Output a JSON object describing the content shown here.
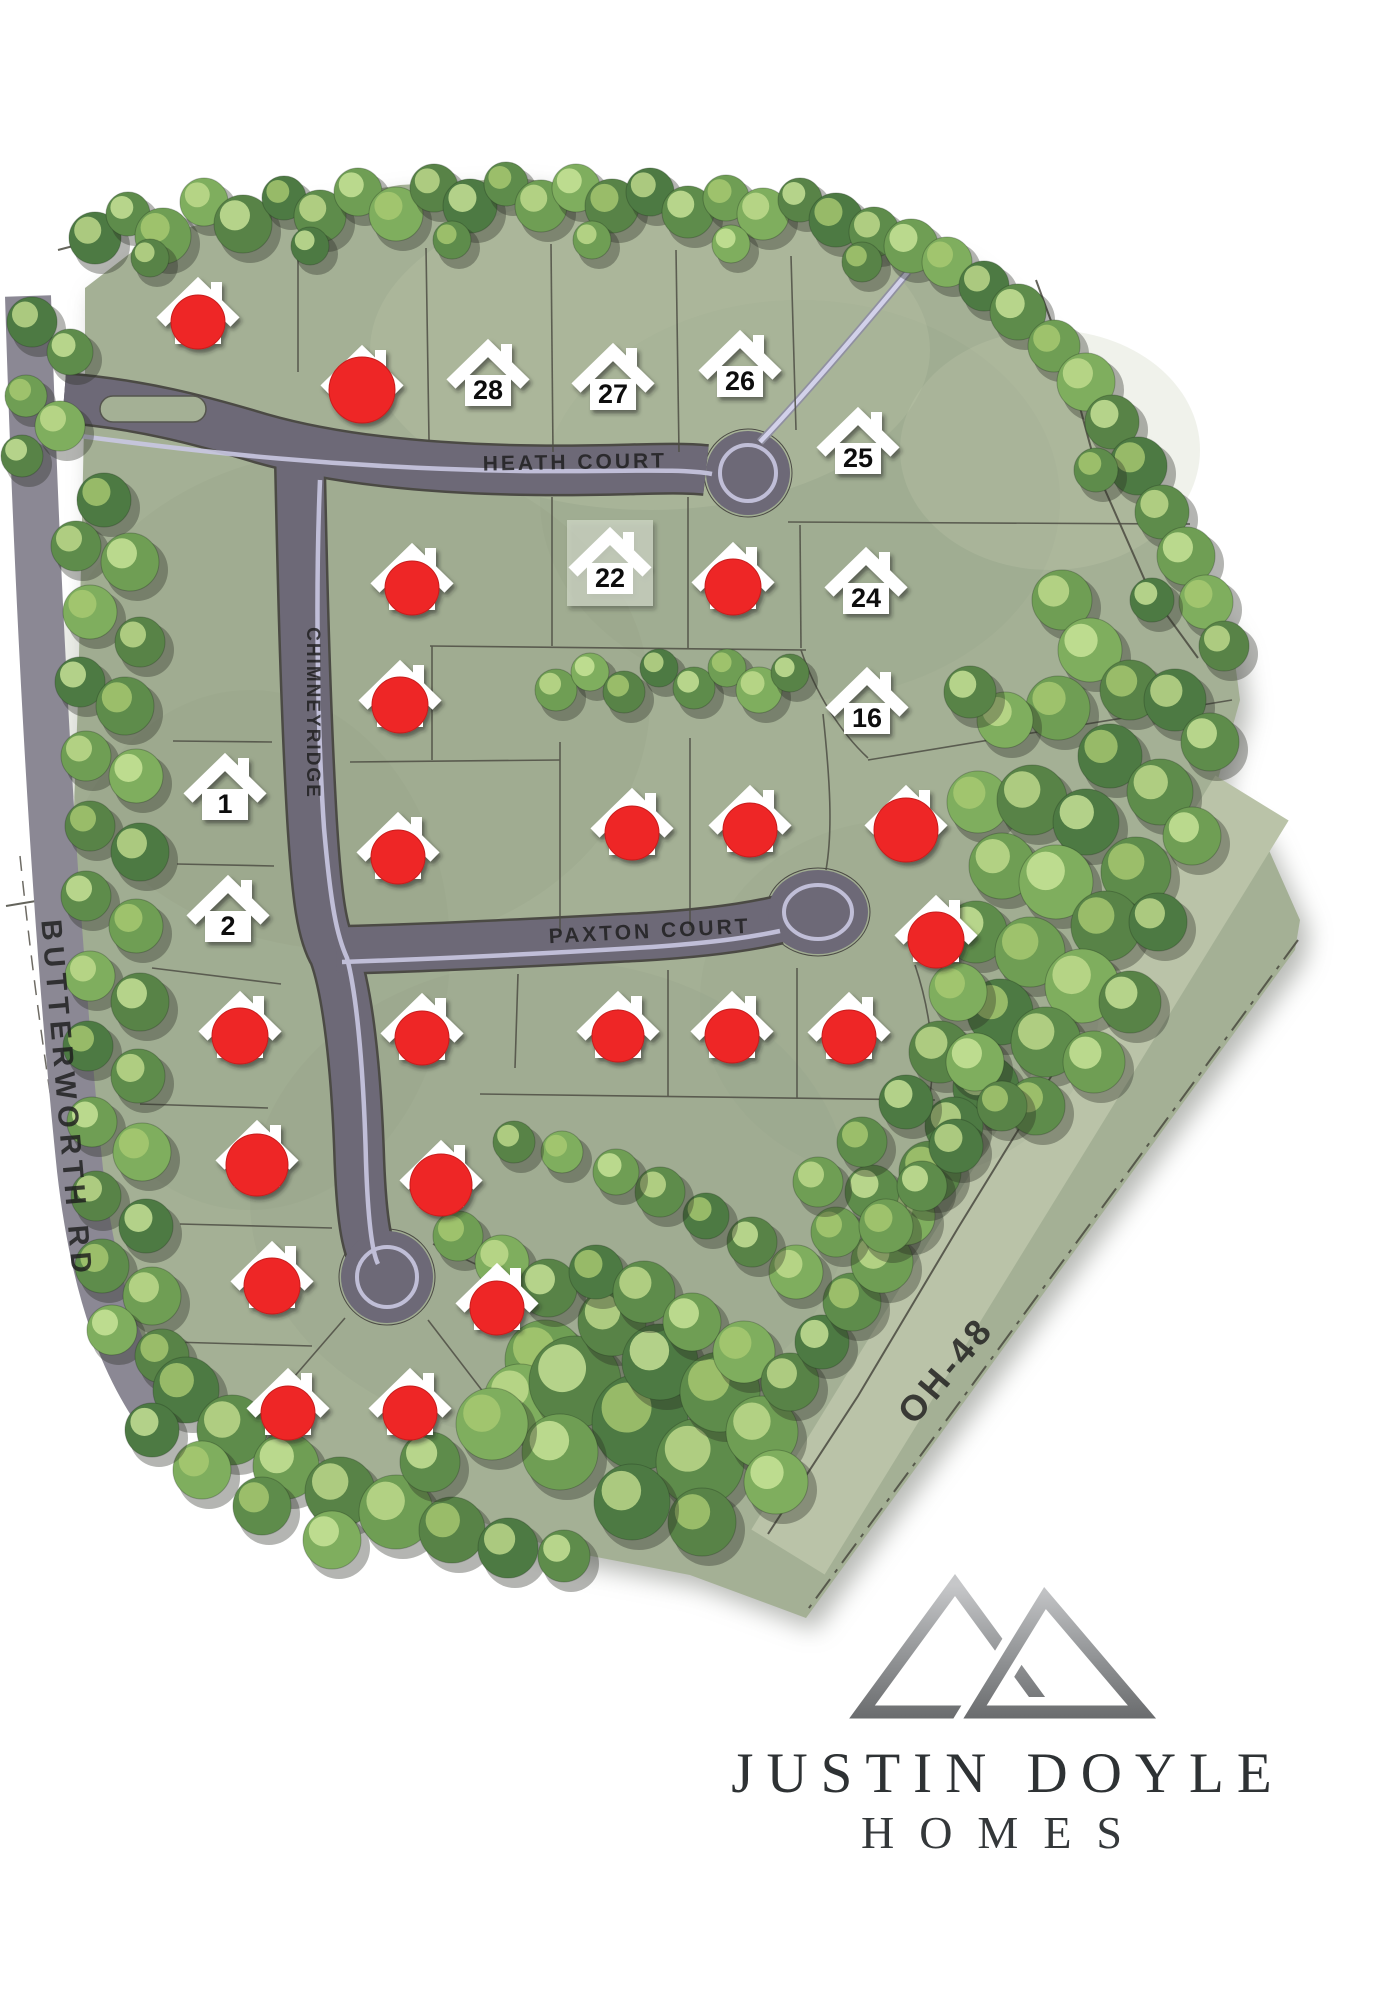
{
  "branding": {
    "name_line1": "JUSTIN DOYLE",
    "name_line2": "HOMES"
  },
  "colors": {
    "site_green": "#a4b095",
    "corridor_green": "#bac3a8",
    "road": "#6d6977",
    "road_edge": "#4b4a44",
    "road_stripe": "#c9c8e2",
    "sold_red": "#ee2525",
    "house_white": "#ffffff",
    "label_ink": "#1d1d1d",
    "logo_text": "#2e3234"
  },
  "streets": {
    "labels": [
      {
        "id": "heath-court",
        "text": "HEATH COURT",
        "x": 575,
        "y": 469,
        "rot": -1,
        "fs": 21,
        "ls": 3
      },
      {
        "id": "paxton-court",
        "text": "PAXTON COURT",
        "x": 650,
        "y": 938,
        "rot": -3,
        "fs": 21,
        "ls": 3
      },
      {
        "id": "chimneyridge",
        "text": "CHIMNEYRIDGE",
        "x": 307,
        "y": 713,
        "rot": 90,
        "fs": 19,
        "ls": 2
      },
      {
        "id": "butterworth-rd",
        "text": "BUTTERWORTH RD",
        "x": 57,
        "y": 1100,
        "rot": 85,
        "fs": 29,
        "ls": 6
      },
      {
        "id": "oh-48",
        "text": "OH-48",
        "x": 955,
        "y": 1378,
        "rot": -50,
        "fs": 36,
        "ls": 4
      }
    ]
  },
  "lots": {
    "available": [
      {
        "num": "1",
        "x": 225,
        "y": 788
      },
      {
        "num": "2",
        "x": 228,
        "y": 910
      },
      {
        "num": "16",
        "x": 867,
        "y": 702
      },
      {
        "num": "22",
        "x": 610,
        "y": 562,
        "highlight": true
      },
      {
        "num": "24",
        "x": 866,
        "y": 582
      },
      {
        "num": "25",
        "x": 858,
        "y": 442
      },
      {
        "num": "26",
        "x": 740,
        "y": 365
      },
      {
        "num": "27",
        "x": 613,
        "y": 378
      },
      {
        "num": "28",
        "x": 488,
        "y": 374
      }
    ],
    "sold": [
      {
        "x": 198,
        "y": 312,
        "r": 27
      },
      {
        "x": 362,
        "y": 380,
        "r": 33
      },
      {
        "x": 412,
        "y": 578,
        "r": 27
      },
      {
        "x": 733,
        "y": 577,
        "r": 28
      },
      {
        "x": 400,
        "y": 695,
        "r": 28
      },
      {
        "x": 632,
        "y": 823,
        "r": 27
      },
      {
        "x": 750,
        "y": 820,
        "r": 27
      },
      {
        "x": 906,
        "y": 820,
        "r": 32
      },
      {
        "x": 398,
        "y": 847,
        "r": 27
      },
      {
        "x": 936,
        "y": 930,
        "r": 28
      },
      {
        "x": 240,
        "y": 1026,
        "r": 28
      },
      {
        "x": 422,
        "y": 1028,
        "r": 27
      },
      {
        "x": 618,
        "y": 1026,
        "r": 26
      },
      {
        "x": 732,
        "y": 1026,
        "r": 27
      },
      {
        "x": 849,
        "y": 1027,
        "r": 27
      },
      {
        "x": 257,
        "y": 1155,
        "r": 31
      },
      {
        "x": 441,
        "y": 1175,
        "r": 31
      },
      {
        "x": 272,
        "y": 1276,
        "r": 28
      },
      {
        "x": 497,
        "y": 1298,
        "r": 27
      },
      {
        "x": 288,
        "y": 1403,
        "r": 27
      },
      {
        "x": 410,
        "y": 1403,
        "r": 27
      }
    ]
  },
  "trees": {
    "items": [
      [
        95,
        238,
        26
      ],
      [
        128,
        214,
        22
      ],
      [
        163,
        236,
        28
      ],
      [
        204,
        202,
        24
      ],
      [
        243,
        224,
        29
      ],
      [
        284,
        198,
        22
      ],
      [
        320,
        216,
        26
      ],
      [
        358,
        192,
        24
      ],
      [
        396,
        214,
        27
      ],
      [
        434,
        188,
        24
      ],
      [
        470,
        206,
        27
      ],
      [
        506,
        184,
        22
      ],
      [
        541,
        206,
        26
      ],
      [
        576,
        188,
        24
      ],
      [
        612,
        206,
        27
      ],
      [
        650,
        192,
        24
      ],
      [
        688,
        212,
        26
      ],
      [
        726,
        198,
        23
      ],
      [
        763,
        214,
        26
      ],
      [
        800,
        200,
        22
      ],
      [
        836,
        220,
        27
      ],
      [
        874,
        232,
        25
      ],
      [
        911,
        246,
        27
      ],
      [
        947,
        262,
        25
      ],
      [
        150,
        258,
        19
      ],
      [
        310,
        246,
        19
      ],
      [
        452,
        240,
        19
      ],
      [
        592,
        240,
        19
      ],
      [
        731,
        244,
        19
      ],
      [
        862,
        262,
        20
      ],
      [
        984,
        286,
        25
      ],
      [
        1018,
        312,
        28
      ],
      [
        1054,
        346,
        26
      ],
      [
        1086,
        382,
        29
      ],
      [
        1112,
        422,
        27
      ],
      [
        1138,
        466,
        29
      ],
      [
        1162,
        512,
        27
      ],
      [
        1186,
        556,
        29
      ],
      [
        1206,
        602,
        27
      ],
      [
        1224,
        646,
        25
      ],
      [
        1152,
        600,
        22
      ],
      [
        1096,
        470,
        22
      ],
      [
        1062,
        600,
        30
      ],
      [
        1090,
        650,
        32
      ],
      [
        1130,
        690,
        30
      ],
      [
        1175,
        700,
        31
      ],
      [
        1210,
        742,
        29
      ],
      [
        1058,
        708,
        32
      ],
      [
        1005,
        720,
        28
      ],
      [
        970,
        692,
        26
      ],
      [
        1110,
        756,
        32
      ],
      [
        1160,
        792,
        33
      ],
      [
        1192,
        836,
        29
      ],
      [
        978,
        802,
        31
      ],
      [
        1032,
        800,
        35
      ],
      [
        1086,
        822,
        33
      ],
      [
        1136,
        872,
        35
      ],
      [
        1002,
        866,
        33
      ],
      [
        1056,
        882,
        37
      ],
      [
        1106,
        926,
        35
      ],
      [
        1158,
        922,
        29
      ],
      [
        976,
        932,
        31
      ],
      [
        1030,
        952,
        35
      ],
      [
        1082,
        986,
        37
      ],
      [
        1130,
        1002,
        31
      ],
      [
        1000,
        1012,
        33
      ],
      [
        1046,
        1042,
        35
      ],
      [
        1094,
        1062,
        31
      ],
      [
        958,
        992,
        29
      ],
      [
        940,
        1052,
        31
      ],
      [
        986,
        1088,
        33
      ],
      [
        1036,
        1106,
        29
      ],
      [
        556,
        690,
        21
      ],
      [
        590,
        672,
        19
      ],
      [
        624,
        692,
        21
      ],
      [
        659,
        668,
        19
      ],
      [
        694,
        688,
        21
      ],
      [
        727,
        668,
        19
      ],
      [
        759,
        690,
        23
      ],
      [
        790,
        673,
        19
      ],
      [
        104,
        500,
        27
      ],
      [
        76,
        546,
        25
      ],
      [
        130,
        562,
        29
      ],
      [
        90,
        612,
        27
      ],
      [
        140,
        642,
        25
      ],
      [
        80,
        682,
        25
      ],
      [
        125,
        706,
        29
      ],
      [
        86,
        756,
        25
      ],
      [
        136,
        776,
        27
      ],
      [
        90,
        826,
        25
      ],
      [
        140,
        852,
        29
      ],
      [
        86,
        896,
        25
      ],
      [
        136,
        926,
        27
      ],
      [
        90,
        976,
        25
      ],
      [
        140,
        1002,
        29
      ],
      [
        88,
        1046,
        25
      ],
      [
        138,
        1076,
        27
      ],
      [
        92,
        1122,
        25
      ],
      [
        142,
        1152,
        29
      ],
      [
        96,
        1196,
        25
      ],
      [
        146,
        1226,
        27
      ],
      [
        102,
        1266,
        27
      ],
      [
        152,
        1296,
        29
      ],
      [
        112,
        1330,
        25
      ],
      [
        162,
        1356,
        27
      ],
      [
        32,
        322,
        25
      ],
      [
        70,
        352,
        23
      ],
      [
        26,
        396,
        21
      ],
      [
        60,
        426,
        25
      ],
      [
        22,
        456,
        21
      ],
      [
        186,
        1390,
        33
      ],
      [
        232,
        1430,
        35
      ],
      [
        286,
        1466,
        33
      ],
      [
        202,
        1470,
        29
      ],
      [
        340,
        1492,
        35
      ],
      [
        152,
        1430,
        27
      ],
      [
        262,
        1506,
        29
      ],
      [
        396,
        1512,
        37
      ],
      [
        332,
        1540,
        29
      ],
      [
        452,
        1530,
        33
      ],
      [
        508,
        1548,
        30
      ],
      [
        564,
        1556,
        26
      ],
      [
        545,
        1360,
        40
      ],
      [
        520,
        1400,
        36
      ],
      [
        575,
        1382,
        46
      ],
      [
        640,
        1422,
        48
      ],
      [
        700,
        1462,
        44
      ],
      [
        560,
        1452,
        38
      ],
      [
        492,
        1424,
        36
      ],
      [
        612,
        1322,
        34
      ],
      [
        660,
        1362,
        38
      ],
      [
        720,
        1392,
        40
      ],
      [
        762,
        1432,
        36
      ],
      [
        776,
        1482,
        32
      ],
      [
        702,
        1522,
        34
      ],
      [
        632,
        1502,
        38
      ],
      [
        430,
        1462,
        30
      ],
      [
        458,
        1236,
        25
      ],
      [
        502,
        1262,
        27
      ],
      [
        548,
        1288,
        29
      ],
      [
        596,
        1272,
        27
      ],
      [
        644,
        1292,
        31
      ],
      [
        692,
        1322,
        29
      ],
      [
        744,
        1352,
        31
      ],
      [
        790,
        1382,
        29
      ],
      [
        822,
        1342,
        27
      ],
      [
        852,
        1302,
        29
      ],
      [
        882,
        1262,
        31
      ],
      [
        906,
        1216,
        29
      ],
      [
        930,
        1172,
        31
      ],
      [
        954,
        1126,
        29
      ],
      [
        872,
        1192,
        27
      ],
      [
        836,
        1232,
        25
      ],
      [
        796,
        1272,
        27
      ],
      [
        752,
        1242,
        25
      ],
      [
        706,
        1216,
        23
      ],
      [
        660,
        1192,
        25
      ],
      [
        616,
        1172,
        23
      ],
      [
        562,
        1152,
        21
      ],
      [
        514,
        1142,
        21
      ],
      [
        906,
        1102,
        27
      ],
      [
        862,
        1142,
        25
      ],
      [
        818,
        1182,
        25
      ],
      [
        975,
        1062,
        29
      ],
      [
        1002,
        1106,
        25
      ],
      [
        956,
        1146,
        27
      ],
      [
        922,
        1186,
        25
      ],
      [
        886,
        1226,
        27
      ]
    ]
  }
}
